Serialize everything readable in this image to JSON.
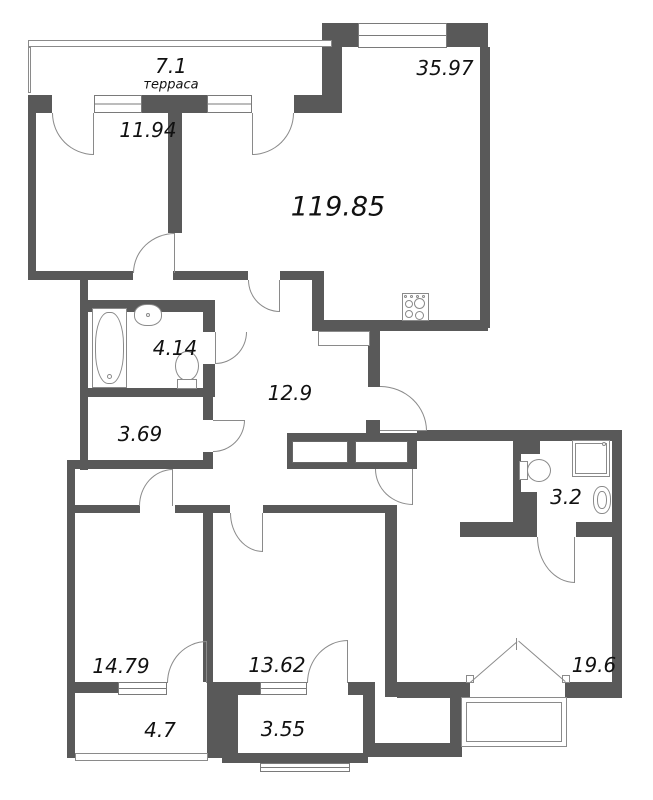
{
  "title": "Apartment floor plan",
  "colors": {
    "wall": "#595959",
    "line": "#8a8a8a",
    "text": "#111111",
    "background": "#ffffff"
  },
  "total_area_label": "119.85",
  "rooms": [
    {
      "name": "terrace-top",
      "area_label": "7.1",
      "sublabel": "терраса",
      "x": 171,
      "y": 66,
      "size": 20
    },
    {
      "name": "room-11-94",
      "area_label": "11.94",
      "x": 148,
      "y": 130,
      "size": 20
    },
    {
      "name": "kitchen-living",
      "area_label": "35.97",
      "x": 445,
      "y": 68,
      "size": 20
    },
    {
      "name": "total-area",
      "area_label": "119.85",
      "x": 338,
      "y": 207,
      "size": 27
    },
    {
      "name": "bathroom-left",
      "area_label": "4.14",
      "x": 175,
      "y": 348,
      "size": 20
    },
    {
      "name": "hallway",
      "area_label": "12.9",
      "x": 290,
      "y": 393,
      "size": 20
    },
    {
      "name": "storage",
      "area_label": "3.69",
      "x": 140,
      "y": 434,
      "size": 20
    },
    {
      "name": "bathroom-right",
      "area_label": "3.2",
      "x": 566,
      "y": 497,
      "size": 20
    },
    {
      "name": "bedroom-left",
      "area_label": "14.79",
      "x": 121,
      "y": 666,
      "size": 20
    },
    {
      "name": "bedroom-middle",
      "area_label": "13.62",
      "x": 277,
      "y": 665,
      "size": 20
    },
    {
      "name": "bedroom-right",
      "area_label": "19.6",
      "x": 594,
      "y": 665,
      "size": 20
    },
    {
      "name": "balcony-left",
      "area_label": "4.7",
      "x": 160,
      "y": 730,
      "size": 20
    },
    {
      "name": "balcony-middle",
      "area_label": "3.55",
      "x": 283,
      "y": 729,
      "size": 20
    }
  ],
  "sublabel_size": 13,
  "walls": [
    [
      28,
      95,
      24,
      18
    ],
    [
      142,
      95,
      65,
      18
    ],
    [
      294,
      95,
      48,
      18
    ],
    [
      322,
      23,
      36,
      24
    ],
    [
      447,
      23,
      41,
      24
    ],
    [
      322,
      47,
      20,
      66
    ],
    [
      480,
      47,
      10,
      281
    ],
    [
      168,
      113,
      14,
      120
    ],
    [
      28,
      113,
      8,
      158
    ],
    [
      28,
      271,
      105,
      9
    ],
    [
      173,
      271,
      75,
      9
    ],
    [
      280,
      271,
      44,
      9
    ],
    [
      312,
      271,
      12,
      57
    ],
    [
      312,
      320,
      176,
      11
    ],
    [
      80,
      280,
      8,
      190
    ],
    [
      88,
      300,
      115,
      12
    ],
    [
      203,
      300,
      12,
      32
    ],
    [
      203,
      364,
      12,
      33
    ],
    [
      80,
      388,
      135,
      9
    ],
    [
      203,
      397,
      10,
      23
    ],
    [
      203,
      452,
      10,
      8
    ],
    [
      67,
      460,
      146,
      9
    ],
    [
      67,
      460,
      8,
      298
    ],
    [
      75,
      505,
      65,
      8
    ],
    [
      175,
      505,
      55,
      8
    ],
    [
      263,
      505,
      130,
      8
    ],
    [
      203,
      513,
      10,
      169
    ],
    [
      67,
      682,
      51,
      11
    ],
    [
      207,
      682,
      31,
      76
    ],
    [
      238,
      682,
      22,
      13
    ],
    [
      348,
      682,
      27,
      13
    ],
    [
      363,
      682,
      12,
      75
    ],
    [
      222,
      753,
      146,
      10
    ],
    [
      385,
      505,
      12,
      192
    ],
    [
      287,
      433,
      173,
      8
    ],
    [
      287,
      463,
      130,
      6
    ],
    [
      287,
      441,
      5,
      22
    ],
    [
      348,
      441,
      7,
      22
    ],
    [
      408,
      441,
      9,
      22
    ],
    [
      368,
      325,
      12,
      62
    ],
    [
      366,
      420,
      14,
      13
    ],
    [
      417,
      430,
      205,
      11
    ],
    [
      612,
      430,
      10,
      268
    ],
    [
      513,
      438,
      8,
      84
    ],
    [
      518,
      438,
      22,
      16
    ],
    [
      521,
      492,
      16,
      30
    ],
    [
      460,
      522,
      77,
      15
    ],
    [
      576,
      522,
      36,
      15
    ],
    [
      397,
      682,
      73,
      16
    ],
    [
      565,
      682,
      57,
      16
    ],
    [
      450,
      697,
      12,
      58
    ],
    [
      375,
      743,
      87,
      14
    ]
  ],
  "windows": [
    {
      "name": "window-terrace-left",
      "box": [
        94,
        95,
        48,
        18
      ]
    },
    {
      "name": "window-terrace-right",
      "box": [
        207,
        95,
        45,
        18
      ]
    },
    {
      "name": "window-kitchen-top",
      "box": [
        358,
        23,
        89,
        25
      ]
    },
    {
      "name": "window-bedroom-left",
      "box": [
        118,
        682,
        49,
        13
      ]
    },
    {
      "name": "window-bedroom-middle",
      "box": [
        260,
        682,
        47,
        13
      ]
    },
    {
      "name": "window-balcony-middle",
      "box": [
        260,
        763,
        90,
        9
      ]
    }
  ],
  "thin_rects": [
    {
      "name": "terrace-rail-top",
      "box": [
        28,
        40,
        304,
        7
      ]
    },
    {
      "name": "terrace-rail-left",
      "box": [
        28,
        47,
        3,
        46
      ]
    },
    {
      "name": "duct-shaft",
      "box": [
        318,
        331,
        52,
        15
      ]
    },
    {
      "name": "balcony-left-rail",
      "box": [
        75,
        753,
        133,
        8
      ]
    },
    {
      "name": "balcony-right-outline",
      "box": [
        461,
        697,
        106,
        50
      ]
    },
    {
      "name": "balcony-right-inner",
      "box": [
        466,
        702,
        96,
        40
      ]
    },
    {
      "name": "french-door-hinge-left",
      "box": [
        466,
        675,
        8,
        8
      ]
    },
    {
      "name": "french-door-hinge-right",
      "box": [
        562,
        675,
        8,
        8
      ]
    }
  ],
  "closets": [
    {
      "name": "wardrobe-1",
      "box": [
        292,
        441,
        56,
        22
      ]
    },
    {
      "name": "wardrobe-2",
      "box": [
        355,
        441,
        53,
        22
      ]
    }
  ],
  "doors": [
    {
      "name": "door-terrace-to-room",
      "box": [
        52,
        113,
        42,
        42
      ],
      "corner": "bl",
      "leaf": "right"
    },
    {
      "name": "door-terrace-to-kitchen",
      "box": [
        252,
        113,
        42,
        42
      ],
      "corner": "br",
      "leaf": "left"
    },
    {
      "name": "door-kitchen-to-hall",
      "box": [
        248,
        280,
        32,
        32
      ],
      "corner": "bl",
      "leaf": "right"
    },
    {
      "name": "door-bathroom-left",
      "box": [
        215,
        332,
        32,
        32
      ],
      "corner": "br",
      "leaf": "left"
    },
    {
      "name": "door-storage",
      "box": [
        213,
        420,
        32,
        32
      ],
      "corner": "br",
      "leaf": "top"
    },
    {
      "name": "door-bedroom-left-balcony",
      "box": [
        167,
        641,
        40,
        42
      ],
      "corner": "tl",
      "leaf": "right"
    },
    {
      "name": "door-bedroom-left",
      "box": [
        139,
        469,
        34,
        37
      ],
      "corner": "tl",
      "leaf": "right"
    },
    {
      "name": "door-bedroom-mid-balcony",
      "box": [
        307,
        640,
        41,
        43
      ],
      "corner": "tl",
      "leaf": "right"
    },
    {
      "name": "door-bedroom-middle",
      "box": [
        230,
        513,
        33,
        39
      ],
      "corner": "bl",
      "leaf": "right"
    },
    {
      "name": "door-bathroom-right",
      "box": [
        537,
        537,
        38,
        46
      ],
      "corner": "bl",
      "leaf": "right"
    },
    {
      "name": "door-entry",
      "box": [
        380,
        386,
        47,
        45
      ],
      "corner": "tr",
      "leaf": "bottom"
    },
    {
      "name": "door-room-11-94",
      "box": [
        133,
        233,
        42,
        40
      ],
      "corner": "tl",
      "leaf": "right"
    },
    {
      "name": "door-hall-lower",
      "box": [
        375,
        469,
        38,
        36
      ],
      "corner": "bl",
      "leaf": "right"
    }
  ],
  "fixtures": [
    {
      "name": "stove",
      "type": "rect",
      "box": [
        402,
        293,
        27,
        28
      ]
    },
    {
      "name": "stove-burner-1",
      "type": "circle",
      "box": [
        405,
        300,
        8,
        8
      ]
    },
    {
      "name": "stove-burner-2",
      "type": "circle",
      "box": [
        414,
        298,
        11,
        11
      ]
    },
    {
      "name": "stove-burner-3",
      "type": "circle",
      "box": [
        405,
        310,
        8,
        8
      ]
    },
    {
      "name": "stove-burner-4",
      "type": "circle",
      "box": [
        415,
        311,
        9,
        9
      ]
    },
    {
      "name": "stove-knob-1",
      "type": "circle",
      "box": [
        404,
        295,
        3,
        3
      ]
    },
    {
      "name": "stove-knob-2",
      "type": "circle",
      "box": [
        410,
        295,
        3,
        3
      ]
    },
    {
      "name": "stove-knob-3",
      "type": "circle",
      "box": [
        416,
        295,
        3,
        3
      ]
    },
    {
      "name": "stove-knob-4",
      "type": "circle",
      "box": [
        422,
        295,
        3,
        3
      ]
    },
    {
      "name": "bathtub",
      "type": "rect",
      "box": [
        92,
        308,
        35,
        80
      ]
    },
    {
      "name": "bathtub-inner",
      "type": "rounded",
      "box": [
        95,
        312,
        29,
        72
      ]
    },
    {
      "name": "bathtub-drain",
      "type": "circle",
      "box": [
        107,
        374,
        5,
        5
      ]
    },
    {
      "name": "sink-left",
      "type": "rounded",
      "box": [
        134,
        304,
        28,
        22
      ]
    },
    {
      "name": "sink-left-dot",
      "type": "circle",
      "box": [
        146,
        313,
        4,
        4
      ]
    },
    {
      "name": "toilet-left-bowl",
      "type": "circle",
      "box": [
        175,
        351,
        24,
        30
      ]
    },
    {
      "name": "toilet-left-tank",
      "type": "rect",
      "box": [
        177,
        379,
        20,
        10
      ]
    },
    {
      "name": "toilet-right-tank",
      "type": "rect",
      "box": [
        519,
        461,
        9,
        19
      ]
    },
    {
      "name": "toilet-right-bowl",
      "type": "circle",
      "box": [
        527,
        459,
        24,
        23
      ]
    },
    {
      "name": "shower-tray",
      "type": "rect",
      "box": [
        572,
        440,
        38,
        37
      ]
    },
    {
      "name": "shower-tray-inner",
      "type": "rect",
      "box": [
        575,
        443,
        32,
        31
      ]
    },
    {
      "name": "shower-dot",
      "type": "circle",
      "box": [
        602,
        442,
        4,
        4
      ]
    },
    {
      "name": "sink-right",
      "type": "rounded",
      "box": [
        593,
        486,
        18,
        28
      ]
    },
    {
      "name": "sink-right-inner",
      "type": "rounded",
      "box": [
        597,
        491,
        10,
        18
      ]
    }
  ],
  "french_door": {
    "name": "french-door-bedroom-right",
    "leaf_left": {
      "x": 470,
      "y": 682,
      "length": 62,
      "angle": -41
    },
    "leaf_right": {
      "x": 565,
      "y": 682,
      "length": 62,
      "angle": -139
    },
    "center_tick": [
      516,
      638,
      1,
      12
    ]
  }
}
